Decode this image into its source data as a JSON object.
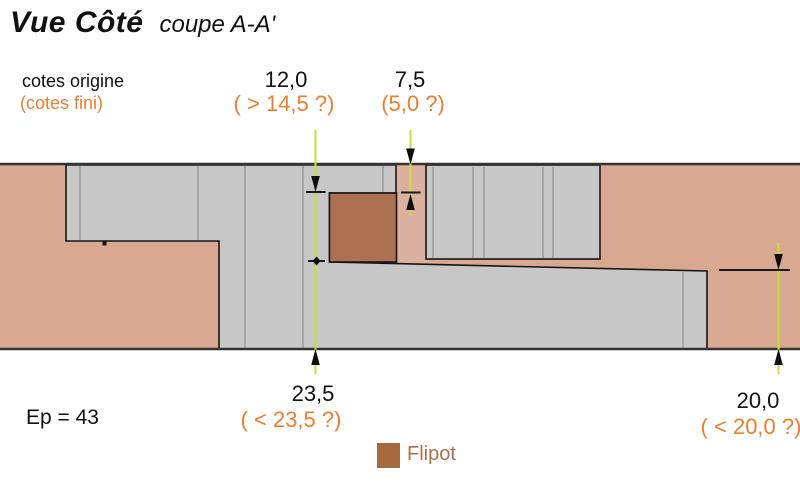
{
  "title": {
    "main": "Vue Côté",
    "sub": "coupe A-A'"
  },
  "legend_key": {
    "origin": "cotes origine",
    "fini": "(cotes fini)"
  },
  "dimensions": {
    "groove_width": {
      "origin": "12,0",
      "fini": "( > 14,5 ?)"
    },
    "groove_depth": {
      "origin": "7,5",
      "fini": "(5,0 ?)"
    },
    "tenon_thickness": {
      "origin": "23,5",
      "fini": "( < 23,5 ?)"
    },
    "rebate_thickness": {
      "origin": "20,0",
      "fini": "( < 20,0 ?)"
    }
  },
  "thickness_label": "Ep = 43",
  "flipot_legend": {
    "label": "Flipot"
  },
  "colors": {
    "wood_side": "#d8a890",
    "wood_strip": "#dcb09e",
    "panel_gray": "#c7c7c7",
    "flipot_brown": "#ae7252",
    "flipot_legend": "#a5693e",
    "dim_line_green": "#c9df3e",
    "accent_orange": "#f07d2b"
  }
}
